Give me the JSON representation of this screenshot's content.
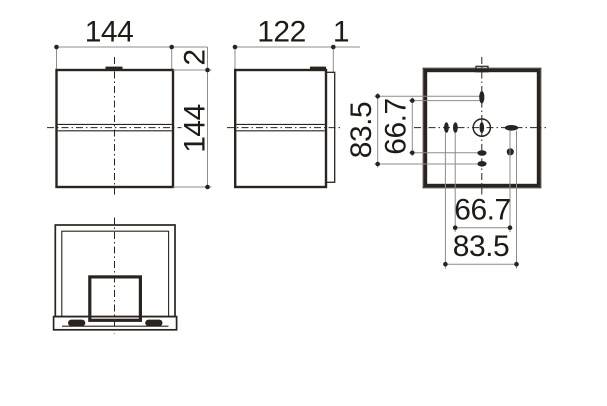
{
  "drawing": {
    "front_view": {
      "width_label": "144",
      "height_label": "144",
      "top_offset_label": "2"
    },
    "side_view": {
      "depth_label": "122",
      "plate_label": "1"
    },
    "rear_view": {
      "vert_outer_label": "83.5",
      "vert_inner_label": "66.7",
      "horiz_inner_label": "66.7",
      "horiz_outer_label": "83.5"
    }
  },
  "colors": {
    "background": "#ffffff",
    "outline": "#2b241e",
    "dimension_line": "#8c8c8c",
    "text": "#201a15"
  }
}
